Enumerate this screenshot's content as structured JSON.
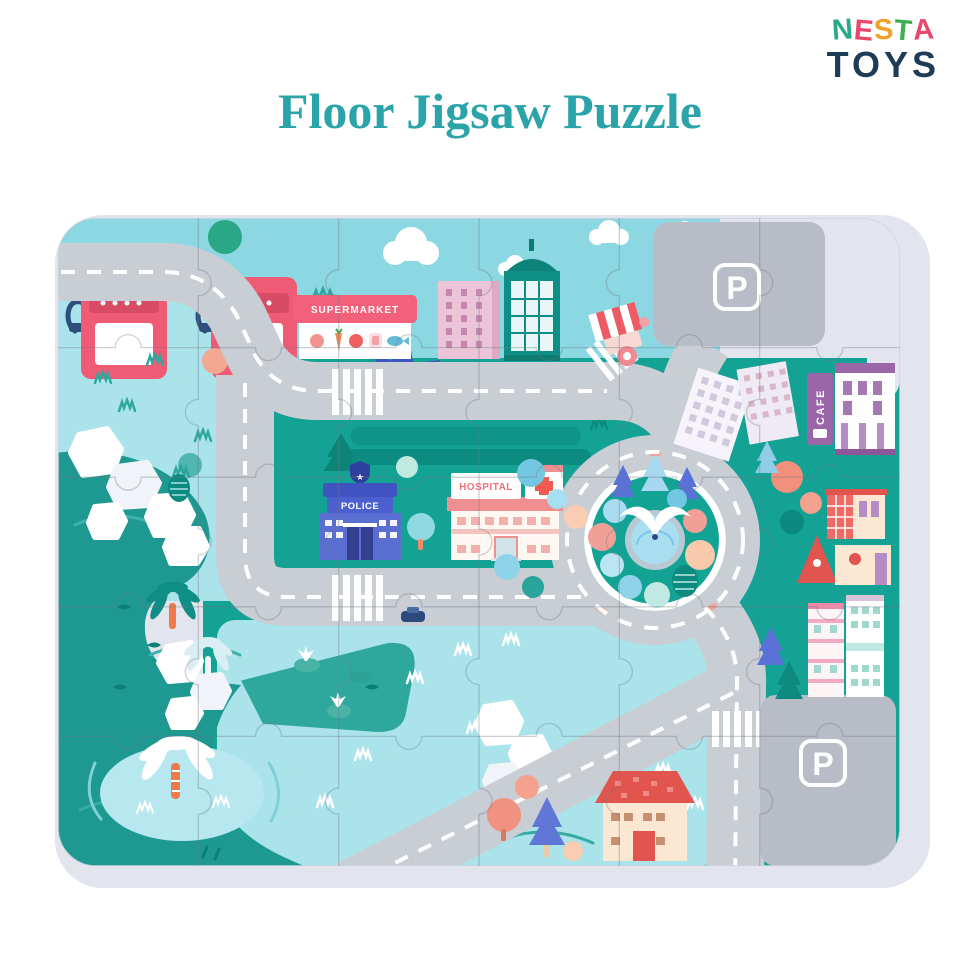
{
  "logo": {
    "nesta": [
      {
        "char": "N",
        "color": "#2aa98a"
      },
      {
        "char": "E",
        "color": "#e8476a"
      },
      {
        "char": "S",
        "color": "#f0a126"
      },
      {
        "char": "T",
        "color": "#3fae52"
      },
      {
        "char": "A",
        "color": "#e8476a"
      }
    ],
    "toys": "TOYS",
    "toys_color": "#1e3c55"
  },
  "title": {
    "text": "Floor Jigsaw Puzzle",
    "color": "#2ba4a9"
  },
  "puzzle": {
    "labels": {
      "supermarket": "SUPERMARKET",
      "hospital": "HOSPITAL",
      "police": "POLICE",
      "cafe": "CAFE",
      "parking_top": "P",
      "parking_bottom": "P",
      "police_badge": "★"
    },
    "grid": {
      "cols": 6,
      "rows": 5
    },
    "colors": {
      "board_border": "#e3e5ee",
      "sky": "#8bd7e2",
      "land_teal": "#13a294",
      "water": "#1d9992",
      "pale_blue": "#abe3ea",
      "road": "#c9cdd4",
      "parking": "#b7bcc6",
      "sign_coral": "#f2607a",
      "police_blue": "#5a6ed2",
      "hospital_pink": "#ef8f8f",
      "cafe_purple": "#9a66a8",
      "roof_red": "#e2544e"
    }
  }
}
